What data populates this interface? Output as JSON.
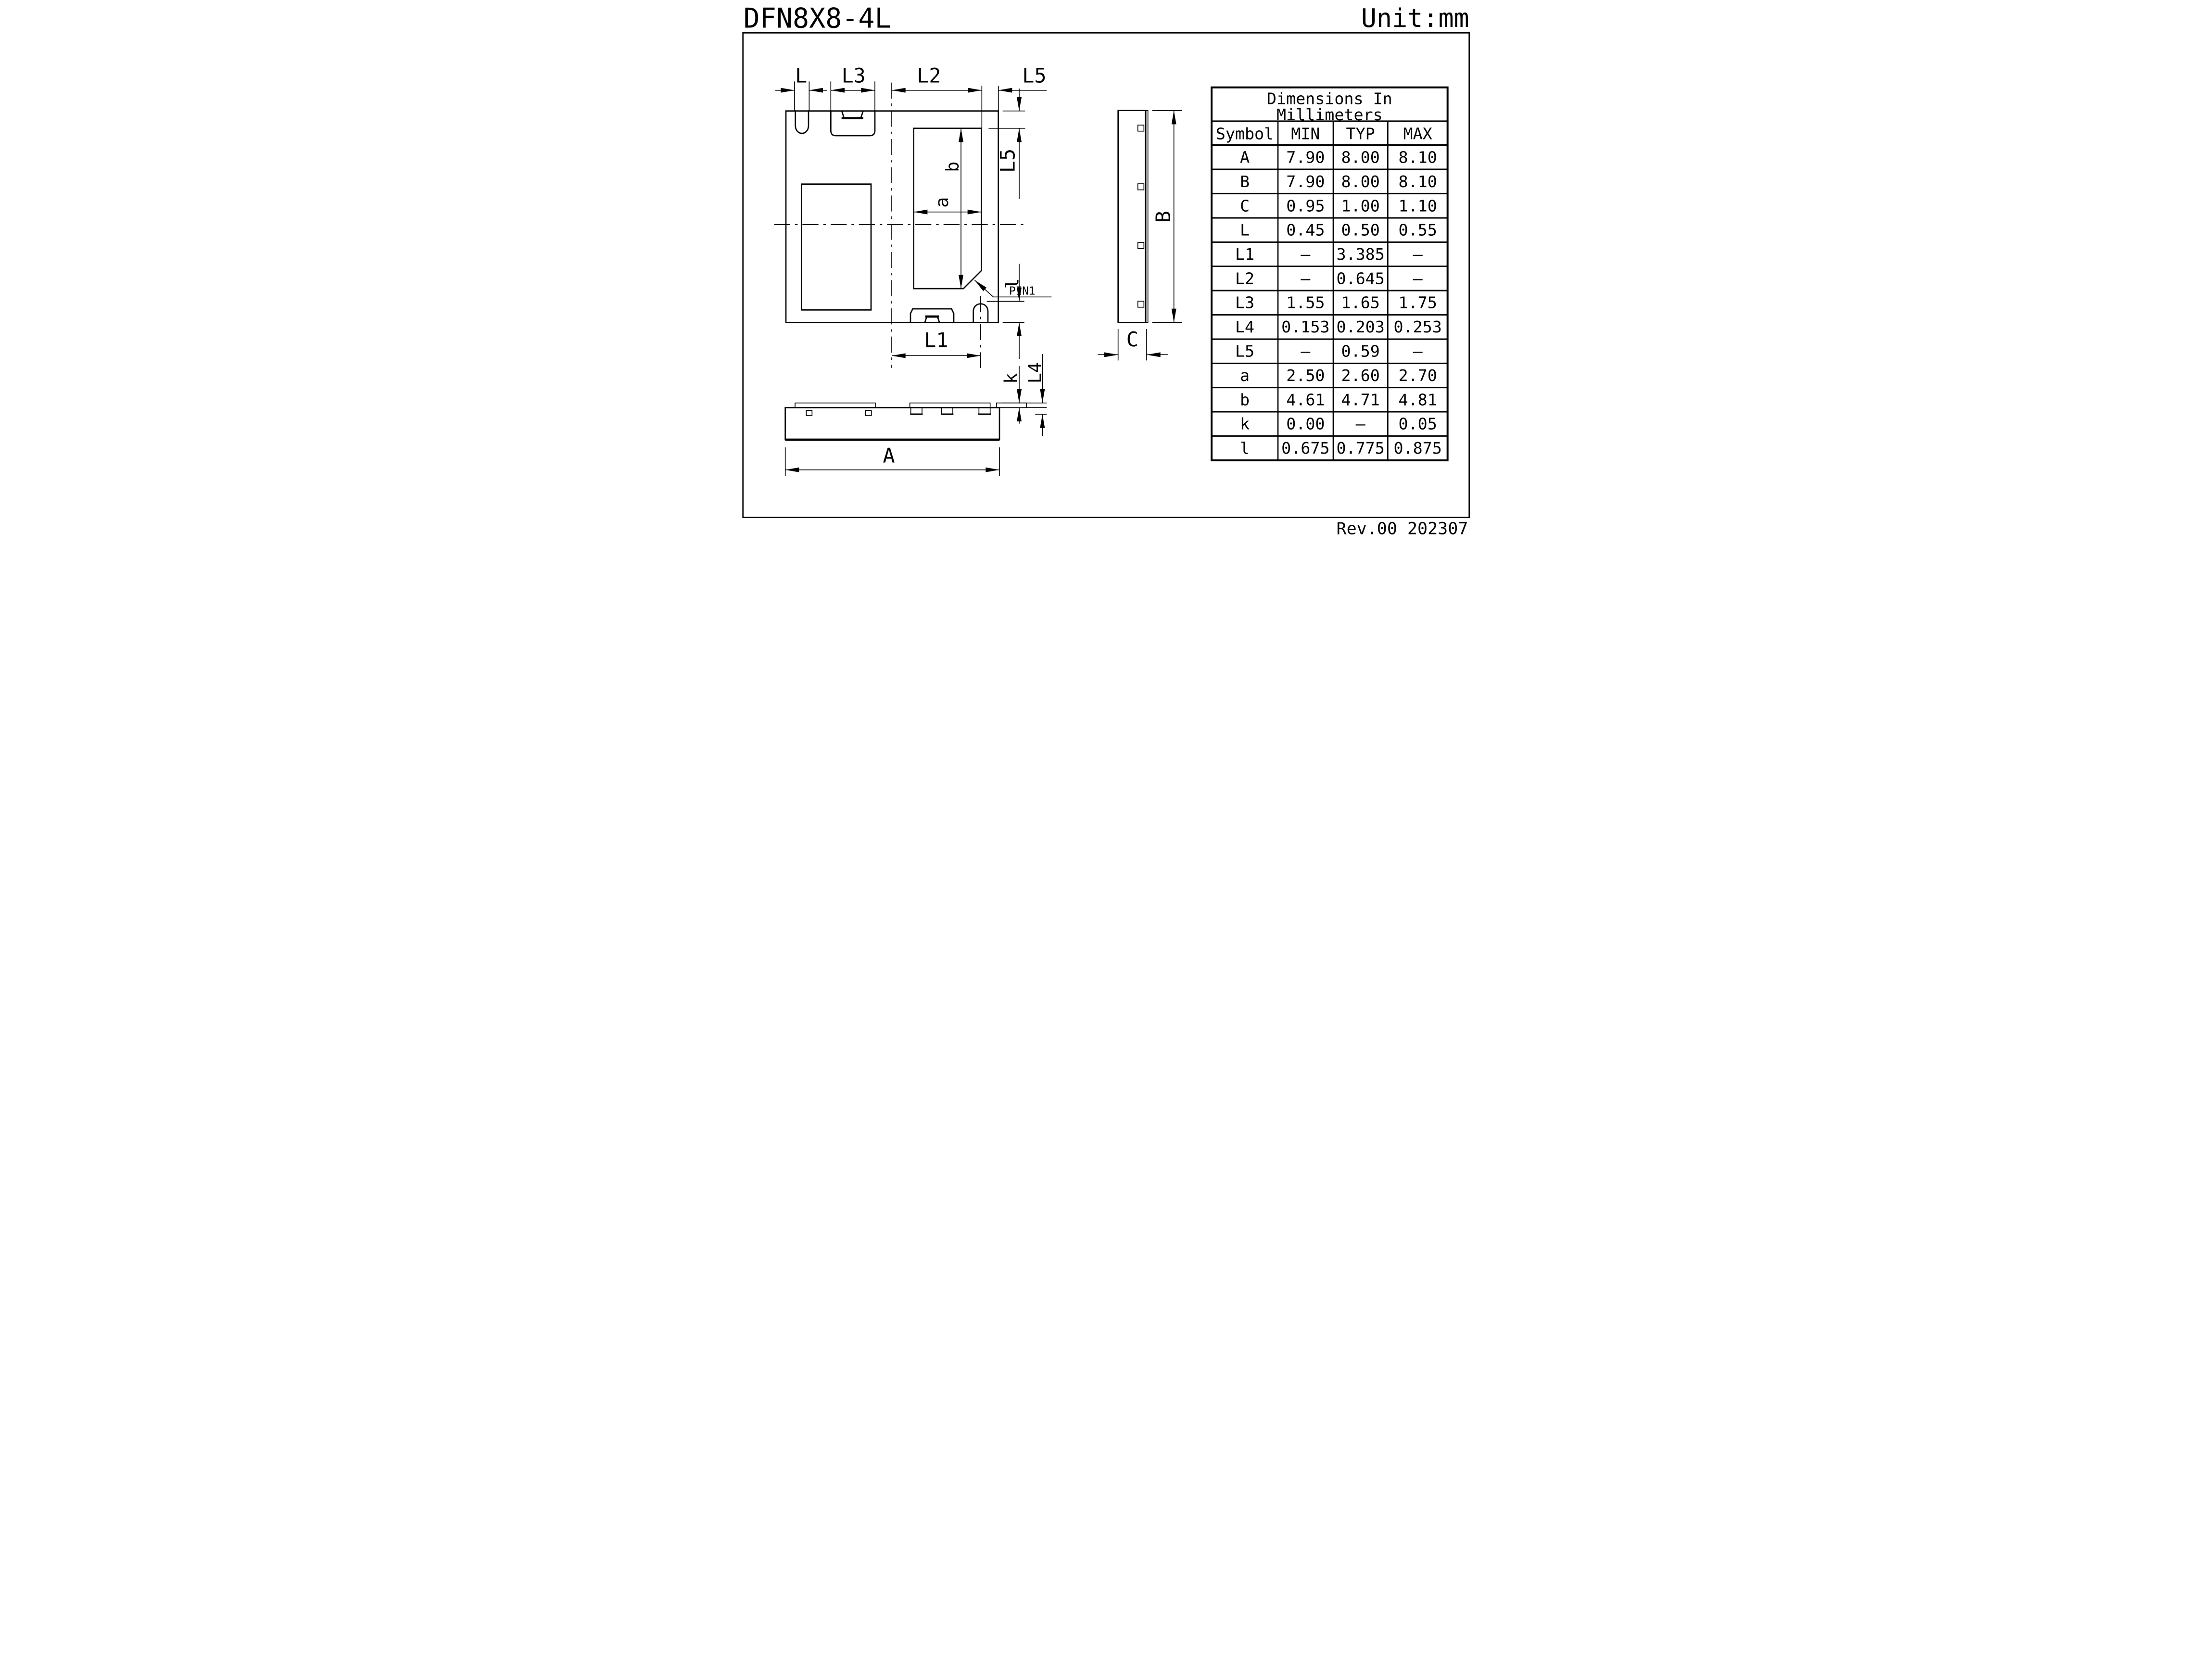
{
  "meta": {
    "title": "DFN8X8-4L",
    "unit_label": "Unit:mm",
    "revision": "Rev.00 202307"
  },
  "table": {
    "title_line1": "Dimensions  In",
    "title_line2": "Millimeters",
    "columns": {
      "symbol": "Symbol",
      "min": "MIN",
      "typ": "TYP",
      "max": "MAX"
    },
    "rows": [
      {
        "symbol": "A",
        "min": "7.90",
        "typ": "8.00",
        "max": "8.10"
      },
      {
        "symbol": "B",
        "min": "7.90",
        "typ": "8.00",
        "max": "8.10"
      },
      {
        "symbol": "C",
        "min": "0.95",
        "typ": "1.00",
        "max": "1.10"
      },
      {
        "symbol": "L",
        "min": "0.45",
        "typ": "0.50",
        "max": "0.55"
      },
      {
        "symbol": "L1",
        "min": "–",
        "typ": "3.385",
        "max": "–"
      },
      {
        "symbol": "L2",
        "min": "–",
        "typ": "0.645",
        "max": "–"
      },
      {
        "symbol": "L3",
        "min": "1.55",
        "typ": "1.65",
        "max": "1.75"
      },
      {
        "symbol": "L4",
        "min": "0.153",
        "typ": "0.203",
        "max": "0.253"
      },
      {
        "symbol": "L5",
        "min": "–",
        "typ": "0.59",
        "max": "–"
      },
      {
        "symbol": "a",
        "min": "2.50",
        "typ": "2.60",
        "max": "2.70"
      },
      {
        "symbol": "b",
        "min": "4.61",
        "typ": "4.71",
        "max": "4.81"
      },
      {
        "symbol": "k",
        "min": "0.00",
        "typ": "–",
        "max": "0.05"
      },
      {
        "symbol": "l",
        "min": "0.675",
        "typ": "0.775",
        "max": "0.875"
      }
    ]
  },
  "drawing": {
    "top_view": {
      "dim_L": "L",
      "dim_L3": "L3",
      "dim_L2": "L2",
      "dim_L5_top": "L5",
      "dim_L5_side": "L5",
      "dim_a": "a",
      "dim_b": "b",
      "dim_l": "l",
      "dim_L1": "L1",
      "pin1": "PIN1"
    },
    "front_view": {
      "dim_A": "A",
      "dim_k": "k",
      "dim_L4": "L4"
    },
    "side_view": {
      "dim_B": "B",
      "dim_C": "C"
    }
  }
}
